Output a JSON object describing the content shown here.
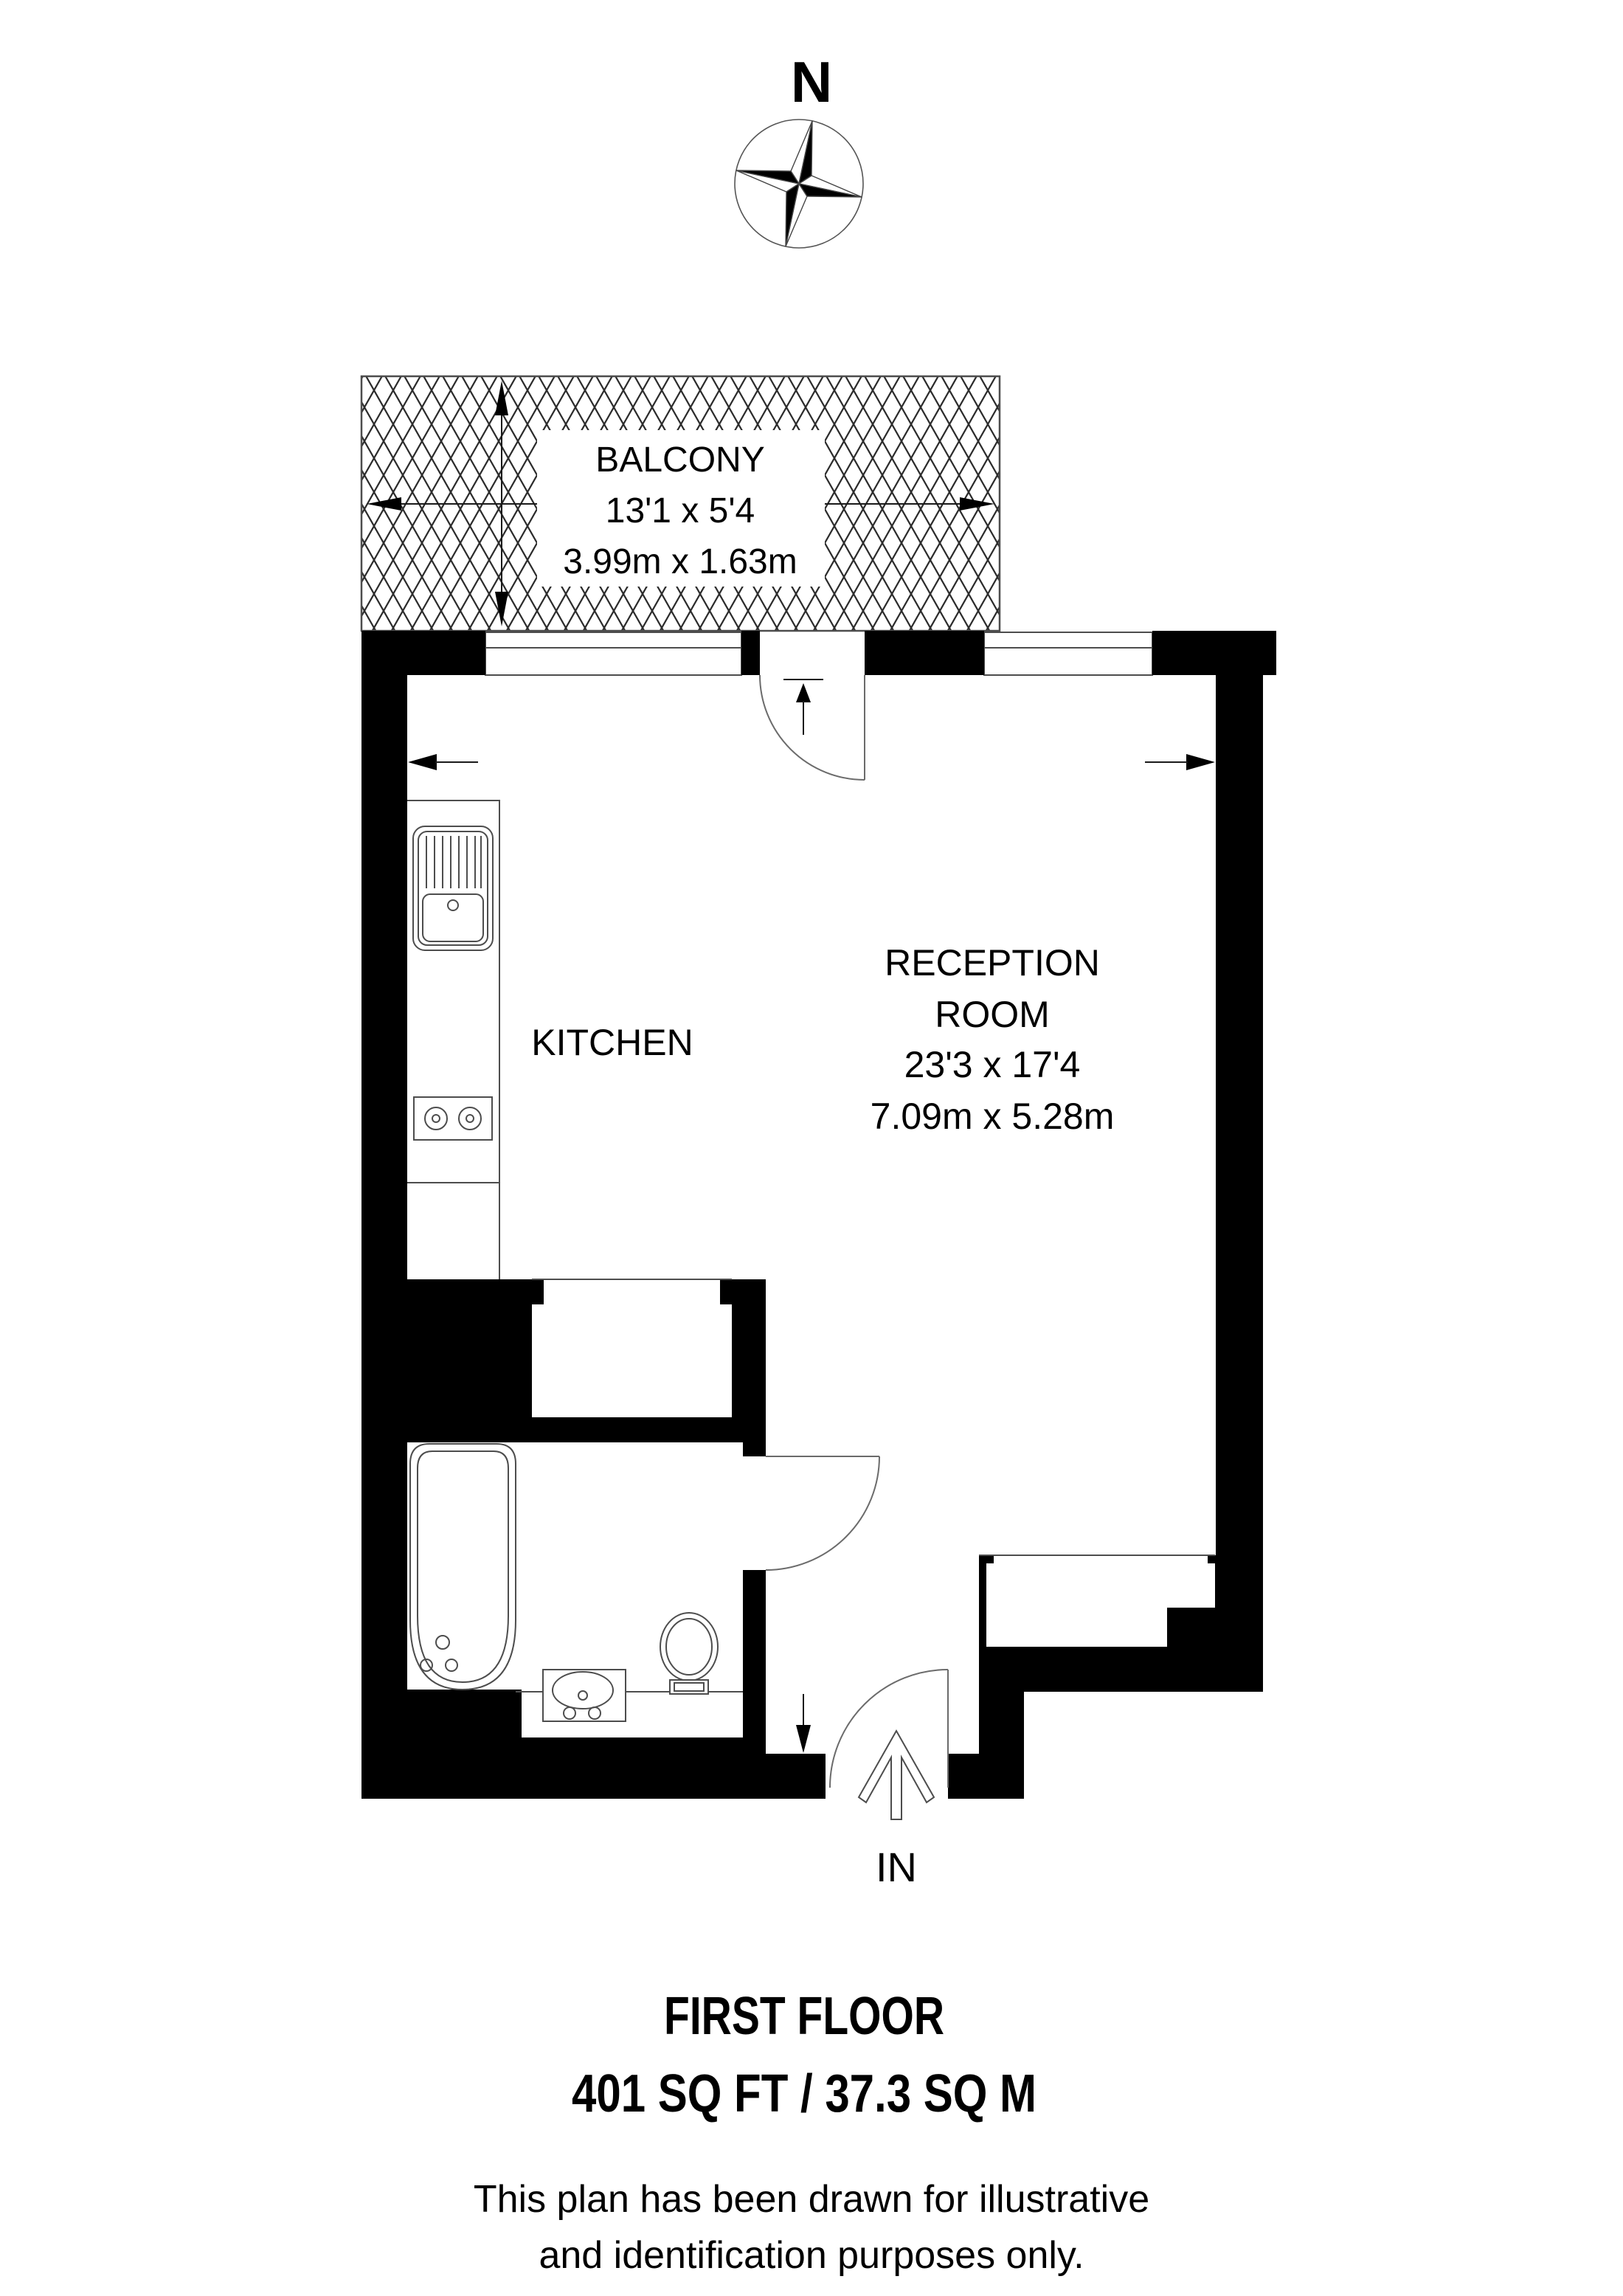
{
  "compass": {
    "label": "N"
  },
  "balcony": {
    "label": "BALCONY",
    "dims_imperial": "13'1 x 5'4",
    "dims_metric": "3.99m x 1.63m"
  },
  "kitchen": {
    "label": "KITCHEN"
  },
  "reception": {
    "label_line1": "RECEPTION",
    "label_line2": "ROOM",
    "dims_imperial": "23'3 x 17'4",
    "dims_metric": "7.09m x 5.28m"
  },
  "entrance": {
    "label": "IN"
  },
  "footer": {
    "floor_label": "FIRST FLOOR",
    "area_label": "401 SQ FT /  37.3 SQ M",
    "disclaimer_line1": "This plan has been drawn for illustrative",
    "disclaimer_line2": "and identification purposes only."
  },
  "colors": {
    "wall": "#000000",
    "thin_line": "#4d4d4d",
    "text": "#000000",
    "background": "#ffffff"
  },
  "icons": {
    "compass-rose-icon": "four-point star, half-filled points, rotated 12deg",
    "door-swing-icon": "quarter-circle arc with leaf line",
    "bathtub-icon": "double rounded rectangle with drain and taps",
    "basin-icon": "oval basin in rectangle with taps",
    "toilet-icon": "oval bowl with cistern",
    "hob-icon": "two burner circles in rectangle",
    "sink-icon": "drainer lines and basin",
    "entry-arrow-icon": "outlined arrow pointing up",
    "dimension-arrow-icon": "thin line with solid triangular heads"
  }
}
